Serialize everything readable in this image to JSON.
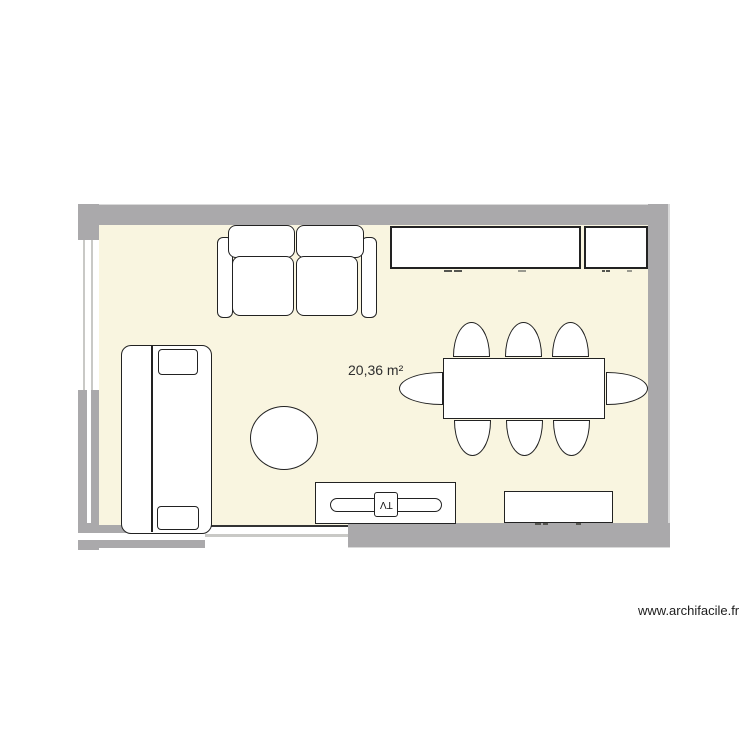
{
  "plan": {
    "area_label": "20,36 m²"
  },
  "labels": {
    "tv": "TV"
  },
  "watermark": {
    "text": "www.archifacile.fr"
  },
  "colors": {
    "wall": "#aaa9ab",
    "wall_edge": "#d9d9d9",
    "floor": "#f9f5e0",
    "outline": "#222222",
    "furniture_fill": "#ffffff",
    "glass_line": "#c9c9c6",
    "text": "#2e2e2e"
  },
  "furniture_names": [
    "two-seat-sofa",
    "wall-cabinet-long",
    "wall-cabinet-small",
    "daybed",
    "round-side-table",
    "dining-table",
    "dining-chair x8",
    "tv-stand",
    "tv",
    "sideboard"
  ],
  "openings": [
    "left-wall-window",
    "left-wall-glazing",
    "bottom-glazed-bay",
    "bottom-window"
  ]
}
